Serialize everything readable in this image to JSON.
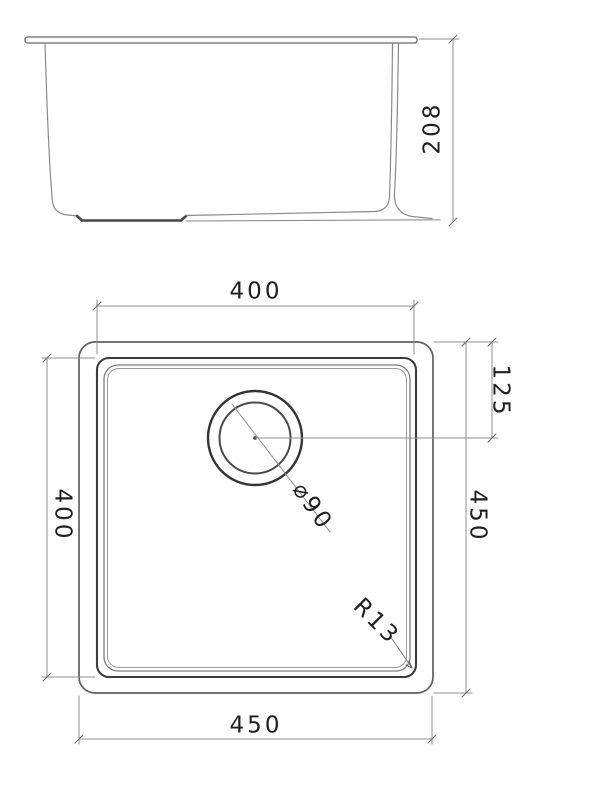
{
  "document": {
    "type": "technical-drawing",
    "subject": "undermount-sink-dimension-drawing",
    "views": {
      "side_elevation": {
        "description": "sink profile with rim, tapered walls and drain pad",
        "dimensions": {
          "depth": "208"
        }
      },
      "plan_view": {
        "description": "square bowl with offset round drain",
        "dimensions": {
          "bowl_width_top": "400",
          "drain_center_offset": "125",
          "bowl_height_left": "400",
          "overall_height_right": "450",
          "drain_diameter": "⌀90",
          "corner_radius": "R13",
          "overall_width_bottom": "450"
        }
      }
    }
  },
  "labels": {
    "depth": "208",
    "top_width": "400",
    "drain_offset": "125",
    "left_height": "400",
    "right_height": "450",
    "drain_diameter": "⌀90",
    "corner_radius": "R13",
    "bottom_width": "450"
  },
  "colors": {
    "background": "#ffffff",
    "heavy_line": "#3c3c3c",
    "medium_line": "#6a6a6a",
    "light_line": "#8f8f8f",
    "text": "#1f1f1f"
  }
}
